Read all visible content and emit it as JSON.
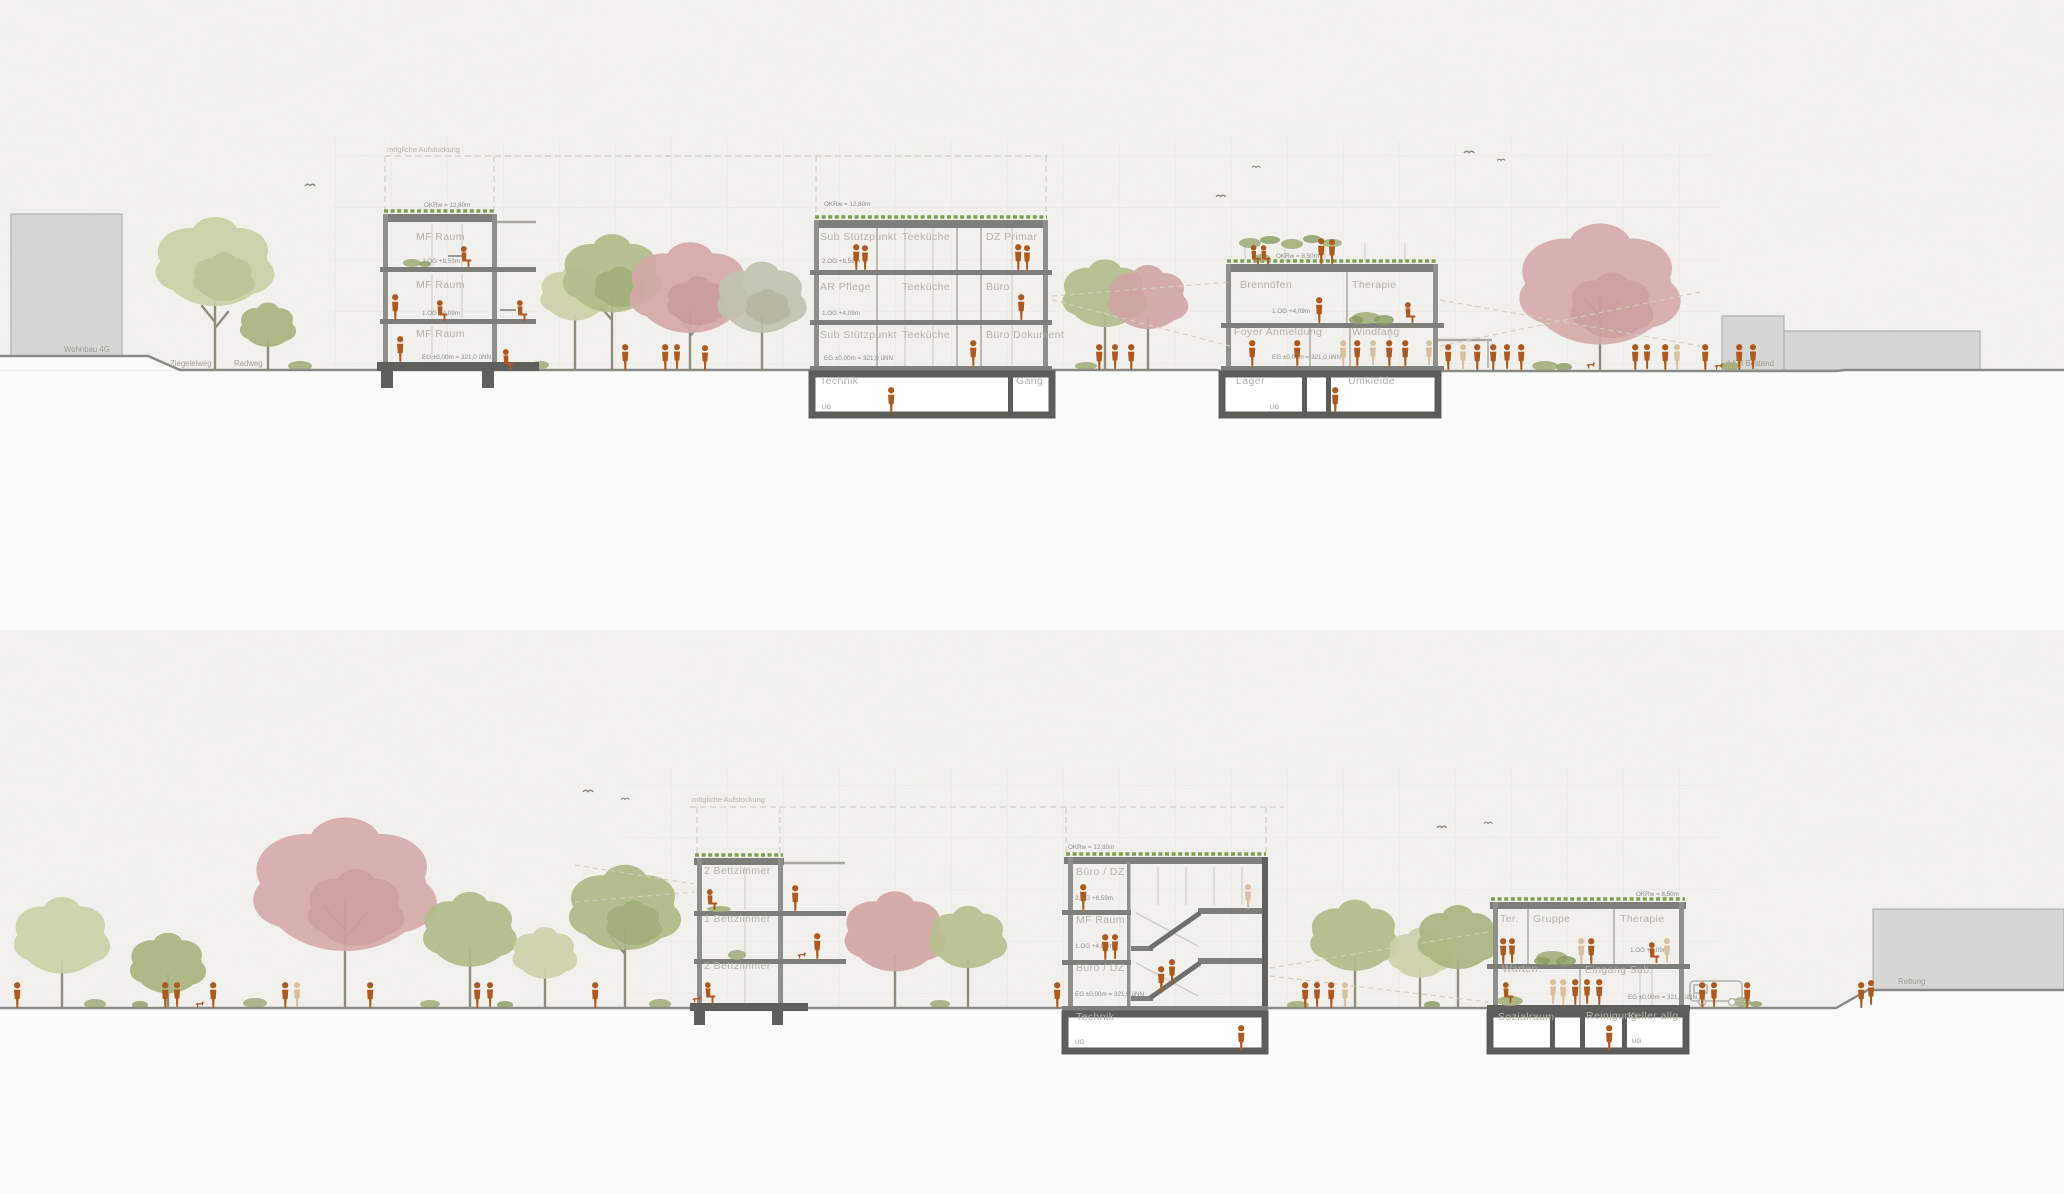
{
  "palette": {
    "paper": "#f2f1ed",
    "figure_rust": "#ad5a20",
    "figure_pale": "#d9c09e",
    "tree_green": "#b2bc8a",
    "tree_pink": "#d5a9a8",
    "green_roof": "#7da150",
    "structure": "#6f6f6c"
  },
  "section_top": {
    "aufstockung_label": "mögliche Aufstockung",
    "context_left_label": "Wohnbau 4G",
    "street_label_1": "Ziegeleiweg",
    "street_label_2": "Radweg",
    "context_right_label": "LKH Bestand",
    "building_a": {
      "roof_elev": "OKRw = 12,80m",
      "room_2og": "MF Raum",
      "room_1og": "MF Raum",
      "room_eg": "MF Raum",
      "elev_2og": "2.OG +8,59m",
      "elev_1og": "1.OG +4,09m",
      "elev_eg": "EG ±0,00m = 321,0 üNN"
    },
    "building_b": {
      "roof_elev": "OKRw = 12,80m",
      "f2": [
        "Sub Stützpunkt",
        "Teeküche",
        "DZ Primar"
      ],
      "f1": [
        "AR Pflege",
        "Teeküche",
        "Büro"
      ],
      "eg": [
        "Sub Stützpunkt",
        "Teeküche",
        "Büro Dokument"
      ],
      "ug": [
        "Technik",
        "Gang"
      ],
      "elev_2og": "2.OG +8,59m",
      "elev_1og": "1.OG +4,09m",
      "elev_eg": "EG ±0,00m = 321,0 üNN",
      "elev_ug": "UG"
    },
    "building_c": {
      "roof_elev": "OKRw = 8,50m",
      "f1": [
        "Brennöfen",
        "Therapie"
      ],
      "eg": [
        "Foyer Anmeldung",
        "Windfang"
      ],
      "ug": [
        "Lager",
        "Umkleide"
      ],
      "elev_1og": "1.OG +4,09m",
      "elev_eg": "EG ±0,00m = 321,0 üNN",
      "elev_ug": "UG"
    }
  },
  "section_bottom": {
    "aufstockung_label": "mögliche Aufstockung",
    "context_right_label": "Rettung",
    "building_d": {
      "room_2og": "2 Bettzimmer",
      "room_1og": "1 Bettzimmer",
      "room_eg": "2 Bettzimmer"
    },
    "building_e": {
      "roof_elev": "OKRw = 12,80m",
      "room_2og": "Büro / DZ",
      "room_1og": "MF Raum",
      "room_eg": "Büro / DZ",
      "room_ug": "Technik",
      "elev_2og": "2.OG +8,59m",
      "elev_1og": "1.OG +4,09m",
      "elev_eg": "EG ±0,00m = 321,0 üNN",
      "elev_ug": "UG"
    },
    "building_f": {
      "roof_elev": "OKRw = 8,50m",
      "f1": [
        "Ter.",
        "Gruppe",
        "Therapie"
      ],
      "eg": [
        "Warten",
        "Eingang Sub."
      ],
      "ug": [
        "Sozialraum",
        "Reinigung",
        "Keller allg."
      ],
      "elev_1og": "1.OG +4,09m",
      "elev_eg": "EG ±0,00m = 321,0 üNN",
      "elev_ug": "UG"
    }
  }
}
